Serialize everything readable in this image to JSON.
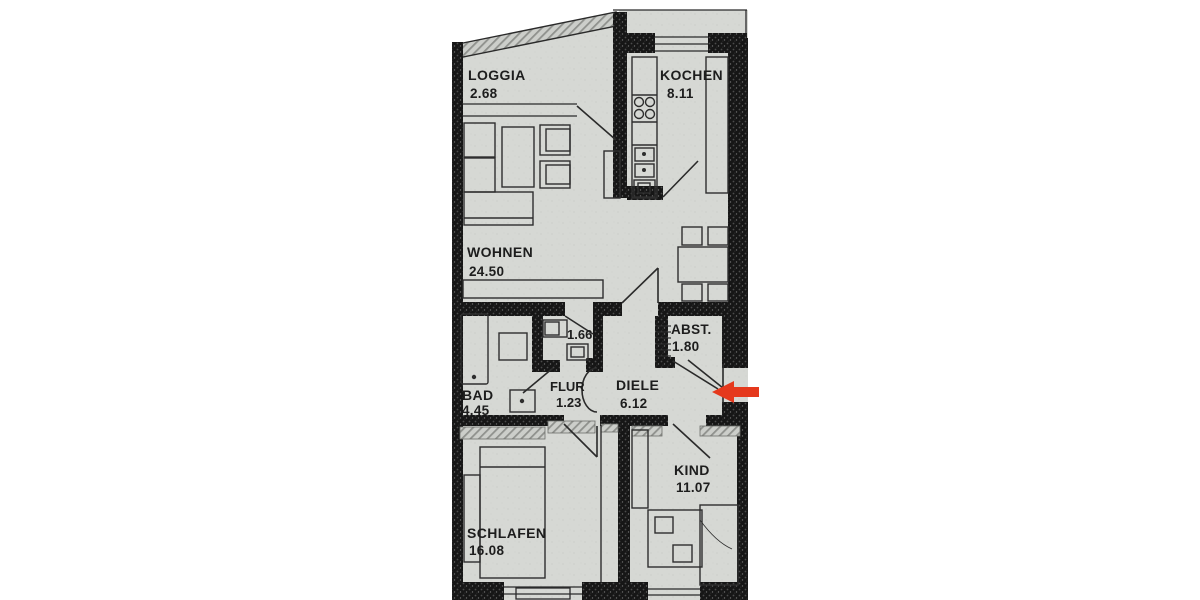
{
  "plan": {
    "type": "apartment-floor-plan",
    "rooms": [
      {
        "id": "loggia",
        "label": "LOGGIA",
        "area": "2.68"
      },
      {
        "id": "kochen",
        "label": "KOCHEN",
        "area": "8.11"
      },
      {
        "id": "wohnen",
        "label": "WOHNEN",
        "area": "24.50"
      },
      {
        "id": "abst",
        "label": "ABST.",
        "area": "1.80"
      },
      {
        "id": "wc",
        "label": "",
        "area": "1.66"
      },
      {
        "id": "bad",
        "label": "BAD",
        "area": "4.45"
      },
      {
        "id": "flur",
        "label": "FLUR",
        "area": "1.23"
      },
      {
        "id": "diele",
        "label": "DIELE",
        "area": "6.12"
      },
      {
        "id": "schlafen",
        "label": "SCHLAFEN",
        "area": "16.08"
      },
      {
        "id": "kind",
        "label": "KIND",
        "area": "11.07"
      }
    ],
    "marker": {
      "id": "entrance-arrow",
      "direction": "left",
      "color": "#e5391d"
    },
    "colors": {
      "paper": "#d6d8d4",
      "wall": "#161616",
      "line": "#2a2a2a",
      "background": "#ffffff"
    }
  }
}
